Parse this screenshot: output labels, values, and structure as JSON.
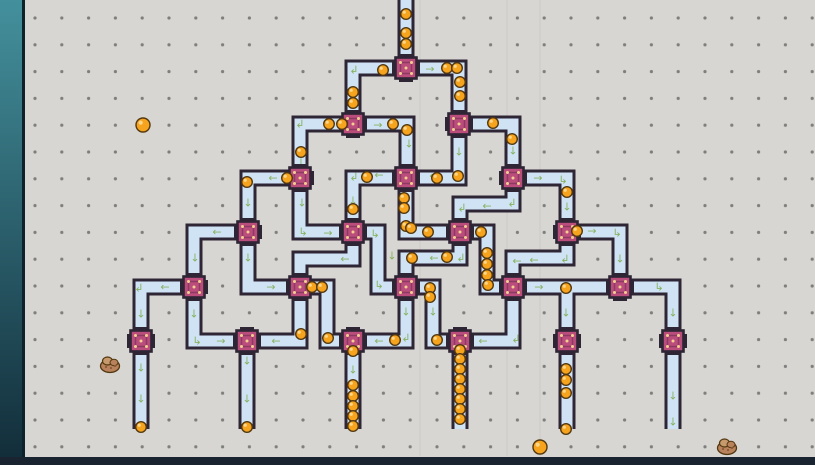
{
  "scene": {
    "width": 815,
    "height": 465
  },
  "colors": {
    "background": "#d7d6d2",
    "grid_dot": "#6e6e6e",
    "tube_wall": "#2e2535",
    "tube_inner": "#cfe3f5",
    "node_fill": "#bb4d7c",
    "node_stroke": "#2e2535",
    "node_inner": "#8c3a63",
    "node_dot": "#f2cf8f",
    "ball_fill": "#f6a41e",
    "ball_stroke": "#53380f",
    "ball_shine": "#ffdf9e",
    "arrow_green": "#85b05c",
    "strip_top": "#43909c",
    "strip_bottom": "#122c39",
    "strip_edge": "#0e222c",
    "bottom_bar": "#1a2430",
    "rock_body": "#b8825c",
    "rock_light": "#c79a6d",
    "rock_dark": "#8a5a3a"
  },
  "grid": {
    "spacing": 26.8,
    "first_x": 35,
    "first_y": 18,
    "dot_r": 1.6,
    "left_clip": 25,
    "bottom_clip": 457
  },
  "hud": {
    "left_strip": {
      "x": 0,
      "width": 22,
      "edge_width": 3
    },
    "bottom_bar": {
      "y": 457,
      "height": 8
    }
  },
  "scratches": [
    420,
    507,
    540
  ],
  "network": {
    "tube_width_outer": 17,
    "tube_width_inner": 11,
    "tubes": [
      {
        "pts": [
          [
            406,
            -6
          ],
          [
            406,
            68
          ]
        ]
      },
      {
        "pts": [
          [
            406,
            68
          ],
          [
            353,
            68
          ],
          [
            353,
            124
          ]
        ]
      },
      {
        "pts": [
          [
            406,
            68
          ],
          [
            459,
            68
          ],
          [
            459,
            124
          ]
        ]
      },
      {
        "pts": [
          [
            353,
            124
          ],
          [
            300,
            124
          ],
          [
            300,
            178
          ]
        ]
      },
      {
        "pts": [
          [
            353,
            124
          ],
          [
            407,
            124
          ],
          [
            407,
            178
          ]
        ]
      },
      {
        "pts": [
          [
            459,
            124
          ],
          [
            459,
            178
          ],
          [
            406,
            178
          ]
        ]
      },
      {
        "pts": [
          [
            459,
            124
          ],
          [
            513,
            124
          ],
          [
            513,
            178
          ]
        ]
      },
      {
        "pts": [
          [
            300,
            178
          ],
          [
            248,
            178
          ],
          [
            248,
            232
          ]
        ]
      },
      {
        "pts": [
          [
            300,
            178
          ],
          [
            300,
            232
          ],
          [
            353,
            232
          ]
        ]
      },
      {
        "pts": [
          [
            406,
            178
          ],
          [
            353,
            178
          ],
          [
            353,
            232
          ]
        ]
      },
      {
        "pts": [
          [
            406,
            178
          ],
          [
            406,
            232
          ],
          [
            460,
            232
          ]
        ]
      },
      {
        "pts": [
          [
            513,
            178
          ],
          [
            513,
            204
          ],
          [
            460,
            204
          ],
          [
            460,
            232
          ]
        ]
      },
      {
        "pts": [
          [
            513,
            178
          ],
          [
            567,
            178
          ],
          [
            567,
            232
          ]
        ]
      },
      {
        "pts": [
          [
            248,
            232
          ],
          [
            194,
            232
          ],
          [
            194,
            287
          ]
        ]
      },
      {
        "pts": [
          [
            248,
            232
          ],
          [
            248,
            287
          ],
          [
            300,
            287
          ]
        ]
      },
      {
        "pts": [
          [
            353,
            232
          ],
          [
            353,
            259
          ],
          [
            300,
            259
          ],
          [
            300,
            287
          ]
        ]
      },
      {
        "pts": [
          [
            353,
            232
          ],
          [
            378,
            232
          ],
          [
            378,
            287
          ],
          [
            406,
            287
          ]
        ]
      },
      {
        "pts": [
          [
            460,
            232
          ],
          [
            460,
            258
          ],
          [
            406,
            258
          ],
          [
            406,
            287
          ]
        ]
      },
      {
        "pts": [
          [
            460,
            232
          ],
          [
            487,
            232
          ],
          [
            487,
            287
          ],
          [
            513,
            287
          ]
        ]
      },
      {
        "pts": [
          [
            567,
            232
          ],
          [
            567,
            258
          ],
          [
            513,
            258
          ],
          [
            513,
            287
          ]
        ]
      },
      {
        "pts": [
          [
            567,
            232
          ],
          [
            620,
            232
          ],
          [
            620,
            287
          ]
        ]
      },
      {
        "pts": [
          [
            194,
            287
          ],
          [
            141,
            287
          ],
          [
            141,
            341
          ]
        ]
      },
      {
        "pts": [
          [
            194,
            287
          ],
          [
            194,
            341
          ],
          [
            247,
            341
          ]
        ]
      },
      {
        "pts": [
          [
            300,
            287
          ],
          [
            300,
            341
          ],
          [
            247,
            341
          ]
        ]
      },
      {
        "pts": [
          [
            300,
            287
          ],
          [
            327,
            287
          ],
          [
            327,
            341
          ],
          [
            353,
            341
          ]
        ]
      },
      {
        "pts": [
          [
            406,
            287
          ],
          [
            406,
            341
          ],
          [
            353,
            341
          ]
        ]
      },
      {
        "pts": [
          [
            406,
            287
          ],
          [
            433,
            287
          ],
          [
            433,
            341
          ],
          [
            460,
            341
          ]
        ]
      },
      {
        "pts": [
          [
            513,
            287
          ],
          [
            513,
            341
          ],
          [
            460,
            341
          ]
        ]
      },
      {
        "pts": [
          [
            513,
            287
          ],
          [
            567,
            287
          ],
          [
            567,
            341
          ]
        ]
      },
      {
        "pts": [
          [
            620,
            287
          ],
          [
            567,
            287
          ]
        ]
      },
      {
        "pts": [
          [
            620,
            287
          ],
          [
            673,
            287
          ],
          [
            673,
            341
          ]
        ]
      },
      {
        "pts": [
          [
            141,
            341
          ],
          [
            141,
            429
          ]
        ]
      },
      {
        "pts": [
          [
            247,
            341
          ],
          [
            247,
            429
          ]
        ]
      },
      {
        "pts": [
          [
            353,
            341
          ],
          [
            353,
            429
          ]
        ]
      },
      {
        "pts": [
          [
            460,
            341
          ],
          [
            460,
            429
          ]
        ]
      },
      {
        "pts": [
          [
            567,
            341
          ],
          [
            567,
            429
          ]
        ]
      },
      {
        "pts": [
          [
            673,
            341
          ],
          [
            673,
            429
          ]
        ]
      }
    ],
    "splitters": [
      {
        "x": 406,
        "y": 68
      },
      {
        "x": 353,
        "y": 124
      },
      {
        "x": 459,
        "y": 124
      },
      {
        "x": 300,
        "y": 178
      },
      {
        "x": 406,
        "y": 178
      },
      {
        "x": 513,
        "y": 178
      },
      {
        "x": 248,
        "y": 232
      },
      {
        "x": 353,
        "y": 232
      },
      {
        "x": 460,
        "y": 232
      },
      {
        "x": 567,
        "y": 232
      },
      {
        "x": 194,
        "y": 287
      },
      {
        "x": 300,
        "y": 287
      },
      {
        "x": 406,
        "y": 287
      },
      {
        "x": 513,
        "y": 287
      },
      {
        "x": 620,
        "y": 287
      }
    ],
    "bins": [
      {
        "x": 141,
        "y": 341
      },
      {
        "x": 247,
        "y": 341
      },
      {
        "x": 353,
        "y": 341
      },
      {
        "x": 460,
        "y": 341
      },
      {
        "x": 567,
        "y": 341
      },
      {
        "x": 673,
        "y": 341
      }
    ],
    "arrows": [
      {
        "x": 430,
        "y": 69,
        "g": "→"
      },
      {
        "x": 354,
        "y": 70,
        "g": "↲"
      },
      {
        "x": 460,
        "y": 97,
        "g": "↓"
      },
      {
        "x": 378,
        "y": 125,
        "g": "→"
      },
      {
        "x": 300,
        "y": 124,
        "g": "↲"
      },
      {
        "x": 301,
        "y": 163,
        "g": "↓"
      },
      {
        "x": 409,
        "y": 144,
        "g": "↓"
      },
      {
        "x": 459,
        "y": 152,
        "g": "↓"
      },
      {
        "x": 538,
        "y": 178,
        "g": "→"
      },
      {
        "x": 563,
        "y": 180,
        "g": "↳"
      },
      {
        "x": 513,
        "y": 151,
        "g": "↓"
      },
      {
        "x": 434,
        "y": 176,
        "g": "←"
      },
      {
        "x": 379,
        "y": 175,
        "g": "←"
      },
      {
        "x": 354,
        "y": 177,
        "g": "↲"
      },
      {
        "x": 273,
        "y": 178,
        "g": "←"
      },
      {
        "x": 248,
        "y": 203,
        "g": "↓"
      },
      {
        "x": 302,
        "y": 203,
        "g": "↓"
      },
      {
        "x": 303,
        "y": 232,
        "g": "↳"
      },
      {
        "x": 328,
        "y": 233,
        "g": "→"
      },
      {
        "x": 353,
        "y": 201,
        "g": "↓"
      },
      {
        "x": 406,
        "y": 206,
        "g": "↓"
      },
      {
        "x": 567,
        "y": 207,
        "g": "↓"
      },
      {
        "x": 512,
        "y": 203,
        "g": "↲"
      },
      {
        "x": 487,
        "y": 206,
        "g": "←"
      },
      {
        "x": 462,
        "y": 208,
        "g": "↲"
      },
      {
        "x": 217,
        "y": 232,
        "g": "←"
      },
      {
        "x": 195,
        "y": 258,
        "g": "↓"
      },
      {
        "x": 248,
        "y": 258,
        "g": "↓"
      },
      {
        "x": 271,
        "y": 287,
        "g": "→"
      },
      {
        "x": 592,
        "y": 231,
        "g": "→"
      },
      {
        "x": 617,
        "y": 233,
        "g": "↳"
      },
      {
        "x": 620,
        "y": 259,
        "g": "↓"
      },
      {
        "x": 565,
        "y": 259,
        "g": "↲"
      },
      {
        "x": 534,
        "y": 260,
        "g": "←"
      },
      {
        "x": 517,
        "y": 261,
        "g": "←"
      },
      {
        "x": 434,
        "y": 258,
        "g": "←"
      },
      {
        "x": 461,
        "y": 258,
        "g": "↲"
      },
      {
        "x": 392,
        "y": 256,
        "g": "↓"
      },
      {
        "x": 379,
        "y": 285,
        "g": "↳"
      },
      {
        "x": 375,
        "y": 234,
        "g": "↳"
      },
      {
        "x": 345,
        "y": 259,
        "g": "←"
      },
      {
        "x": 539,
        "y": 287,
        "g": "→"
      },
      {
        "x": 659,
        "y": 287,
        "g": "↳"
      },
      {
        "x": 673,
        "y": 313,
        "g": "↓"
      },
      {
        "x": 673,
        "y": 396,
        "g": "↓"
      },
      {
        "x": 673,
        "y": 422,
        "g": "↓"
      },
      {
        "x": 566,
        "y": 313,
        "g": "↓"
      },
      {
        "x": 165,
        "y": 287,
        "g": "←"
      },
      {
        "x": 139,
        "y": 288,
        "g": "↲"
      },
      {
        "x": 141,
        "y": 314,
        "g": "↓"
      },
      {
        "x": 141,
        "y": 368,
        "g": "↓"
      },
      {
        "x": 141,
        "y": 399,
        "g": "↓"
      },
      {
        "x": 194,
        "y": 314,
        "g": "↓"
      },
      {
        "x": 197,
        "y": 341,
        "g": "↳"
      },
      {
        "x": 221,
        "y": 341,
        "g": "→"
      },
      {
        "x": 276,
        "y": 341,
        "g": "←"
      },
      {
        "x": 247,
        "y": 361,
        "g": "↓"
      },
      {
        "x": 247,
        "y": 399,
        "g": "↓"
      },
      {
        "x": 433,
        "y": 312,
        "g": "↓"
      },
      {
        "x": 483,
        "y": 341,
        "g": "←"
      },
      {
        "x": 516,
        "y": 339,
        "g": "↲"
      },
      {
        "x": 406,
        "y": 312,
        "g": "↓"
      },
      {
        "x": 379,
        "y": 341,
        "g": "←"
      },
      {
        "x": 406,
        "y": 338,
        "g": "↲"
      },
      {
        "x": 353,
        "y": 370,
        "g": "↓"
      }
    ],
    "balls": [
      [
        406,
        14
      ],
      [
        406,
        33
      ],
      [
        406,
        44
      ],
      [
        383,
        70
      ],
      [
        447,
        68
      ],
      [
        457,
        68
      ],
      [
        460,
        82
      ],
      [
        460,
        96
      ],
      [
        353,
        92
      ],
      [
        353,
        103
      ],
      [
        329,
        124
      ],
      [
        342,
        124
      ],
      [
        393,
        124
      ],
      [
        407,
        130
      ],
      [
        493,
        123
      ],
      [
        512,
        139
      ],
      [
        437,
        178
      ],
      [
        458,
        176
      ],
      [
        367,
        177
      ],
      [
        287,
        178
      ],
      [
        247,
        182
      ],
      [
        301,
        152
      ],
      [
        353,
        209
      ],
      [
        404,
        198
      ],
      [
        404,
        208
      ],
      [
        406,
        226
      ],
      [
        411,
        228
      ],
      [
        428,
        232
      ],
      [
        567,
        192
      ],
      [
        577,
        231
      ],
      [
        481,
        232
      ],
      [
        487,
        253
      ],
      [
        487,
        264
      ],
      [
        487,
        275
      ],
      [
        488,
        285
      ],
      [
        412,
        258
      ],
      [
        447,
        257
      ],
      [
        312,
        287
      ],
      [
        322,
        287
      ],
      [
        566,
        288
      ],
      [
        301,
        334
      ],
      [
        328,
        338
      ],
      [
        395,
        340
      ],
      [
        430,
        288
      ],
      [
        430,
        297
      ],
      [
        437,
        340
      ],
      [
        353,
        351
      ],
      [
        353,
        385
      ],
      [
        353,
        396
      ],
      [
        353,
        406
      ],
      [
        353,
        416
      ],
      [
        353,
        426
      ],
      [
        460,
        350
      ],
      [
        460,
        359
      ],
      [
        460,
        369
      ],
      [
        460,
        379
      ],
      [
        460,
        389
      ],
      [
        460,
        399
      ],
      [
        460,
        409
      ],
      [
        460,
        419
      ],
      [
        566,
        369
      ],
      [
        566,
        380
      ],
      [
        566,
        393
      ],
      [
        566,
        429
      ],
      [
        141,
        427
      ],
      [
        247,
        427
      ]
    ],
    "loose_balls": [
      [
        143,
        125
      ],
      [
        540,
        447
      ]
    ],
    "rocks": [
      [
        110,
        366
      ],
      [
        727,
        448
      ]
    ]
  }
}
